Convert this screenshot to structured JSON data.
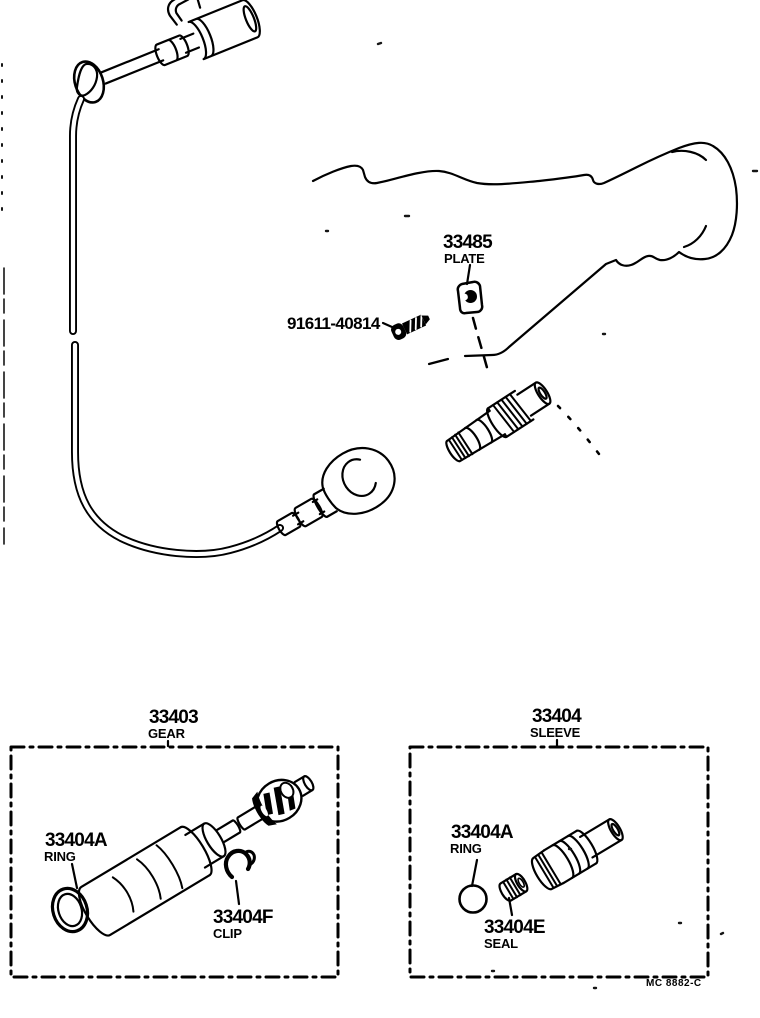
{
  "diagram": {
    "kind": "exploded-parts-diagram",
    "background": "#ffffff",
    "ink": "#000000",
    "footer_code": "MC 8882-C"
  },
  "labels": {
    "plate": {
      "number": "33485",
      "name": "PLATE"
    },
    "screw": {
      "number": "91611-40814"
    },
    "gear_box": {
      "number": "33403",
      "name": "GEAR"
    },
    "sleeve_box": {
      "number": "33404",
      "name": "SLEEVE"
    },
    "gear_ring": {
      "number": "33404A",
      "name": "RING"
    },
    "gear_clip": {
      "number": "33404F",
      "name": "CLIP"
    },
    "sleeve_ring": {
      "number": "33404A",
      "name": "RING"
    },
    "sleeve_seal": {
      "number": "33404E",
      "name": "SEAL"
    },
    "footer_code": "MC 8882-C"
  }
}
